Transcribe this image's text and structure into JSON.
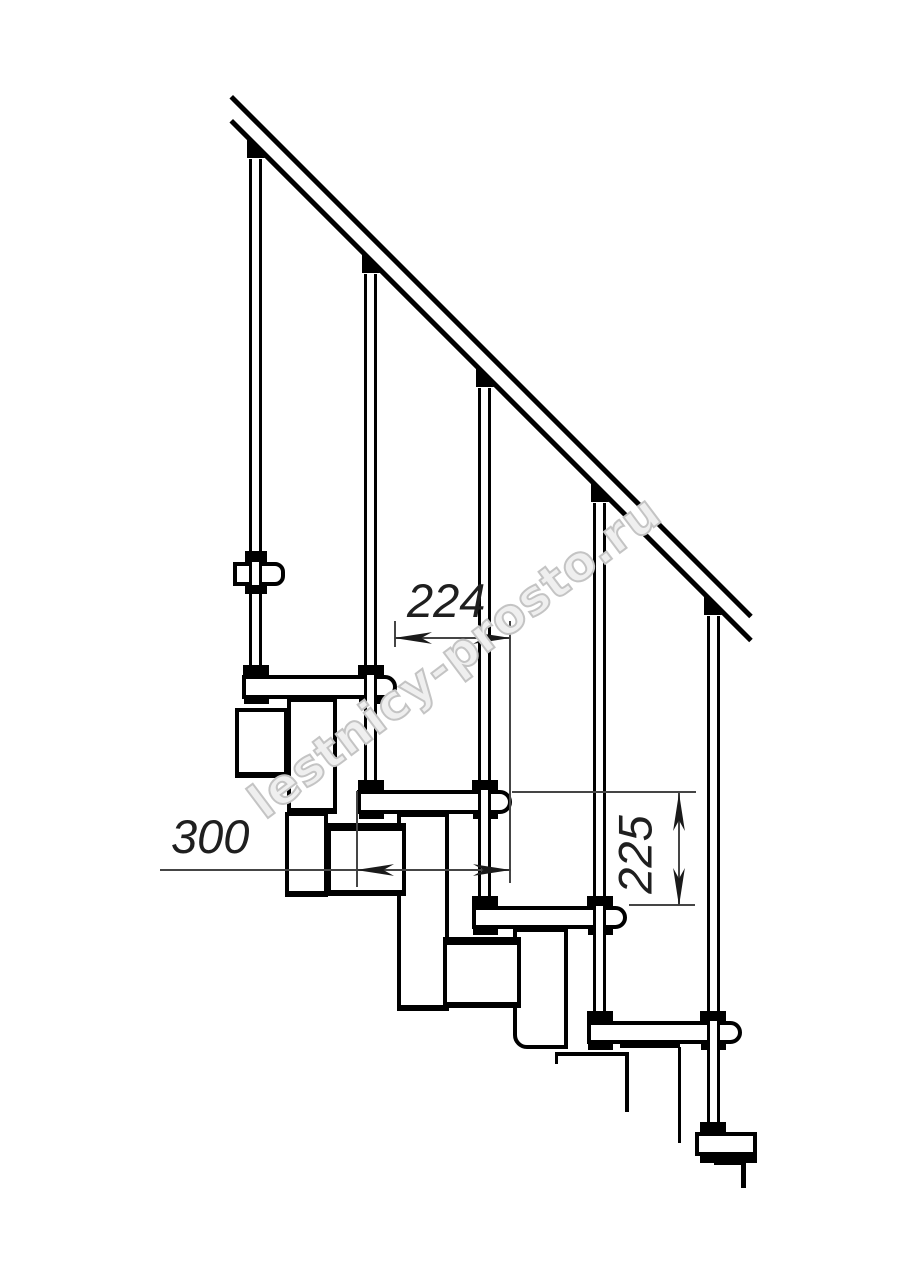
{
  "drawing": {
    "kind": "modular staircase side-view blueprint",
    "dimensions": {
      "step_run": {
        "value": "224"
      },
      "tread_depth": {
        "value": "300"
      },
      "riser_height": {
        "value": "225"
      }
    },
    "watermark": {
      "text": "lestnicy-prosto.ru"
    },
    "colors": {
      "line": "#000000",
      "dimension_line": "#454545",
      "watermark_outline": "#c4c4c4",
      "background": "#ffffff"
    }
  }
}
